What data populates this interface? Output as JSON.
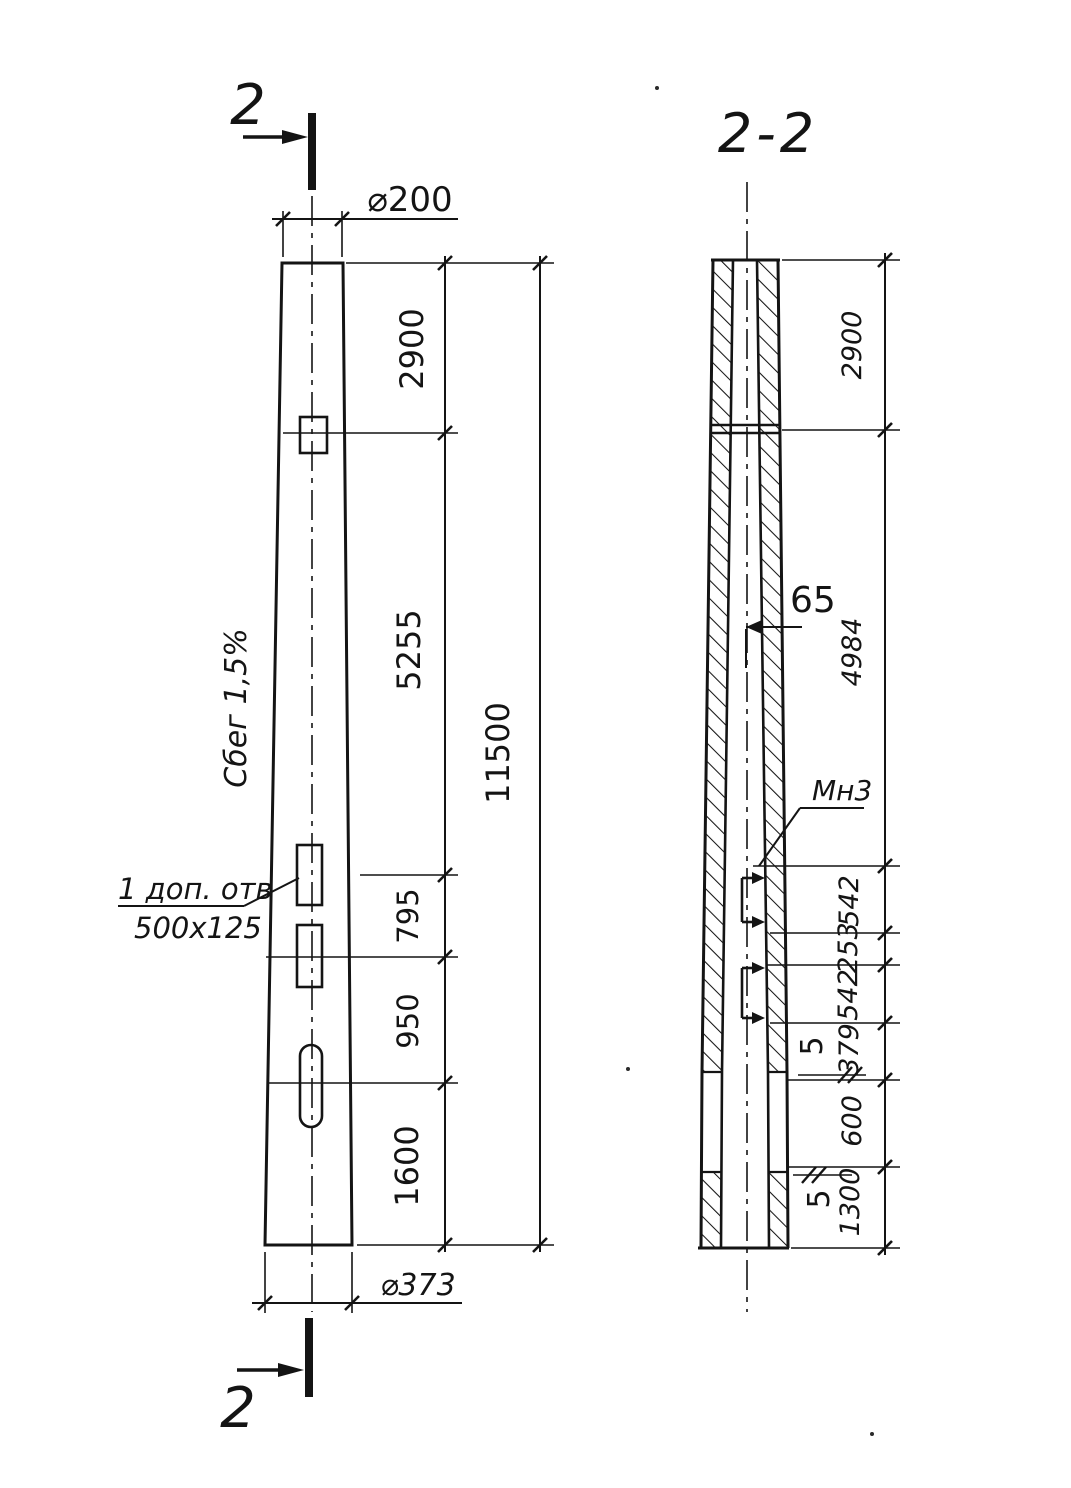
{
  "meta": {
    "ink_color": "#141414",
    "background_color": "#ffffff",
    "drawing_type": "tapered hollow pole, elevation and longitudinal section"
  },
  "markers": {
    "section_cut_top": "2",
    "section_cut_bottom": "2",
    "section_title": "2-2"
  },
  "front_view": {
    "dim_top_diameter": "⌀200",
    "dim_bottom_diameter": "⌀373",
    "dim_seg_2900": "2900",
    "dim_seg_5255": "5255",
    "dim_seg_795": "795",
    "dim_seg_950": "950",
    "dim_seg_1600": "1600",
    "dim_total_length": "11500",
    "taper_label": "Сбег 1,5%",
    "hole_note_line1": "1 доп. отв",
    "hole_note_line2": "500x125"
  },
  "section_view": {
    "dim_seg_2900": "2900",
    "dim_seg_4984": "4984",
    "dim_seg_542a": "542",
    "dim_seg_253": "253",
    "dim_seg_542b": "542",
    "dim_seg_379": "379",
    "dim_seg_600": "600",
    "dim_seg_1300": "1300",
    "dim_bore_65": "65",
    "dim_plate_thickness_a": "5",
    "dim_plate_thickness_b": "5",
    "embedded_item_label": "Мн3"
  }
}
